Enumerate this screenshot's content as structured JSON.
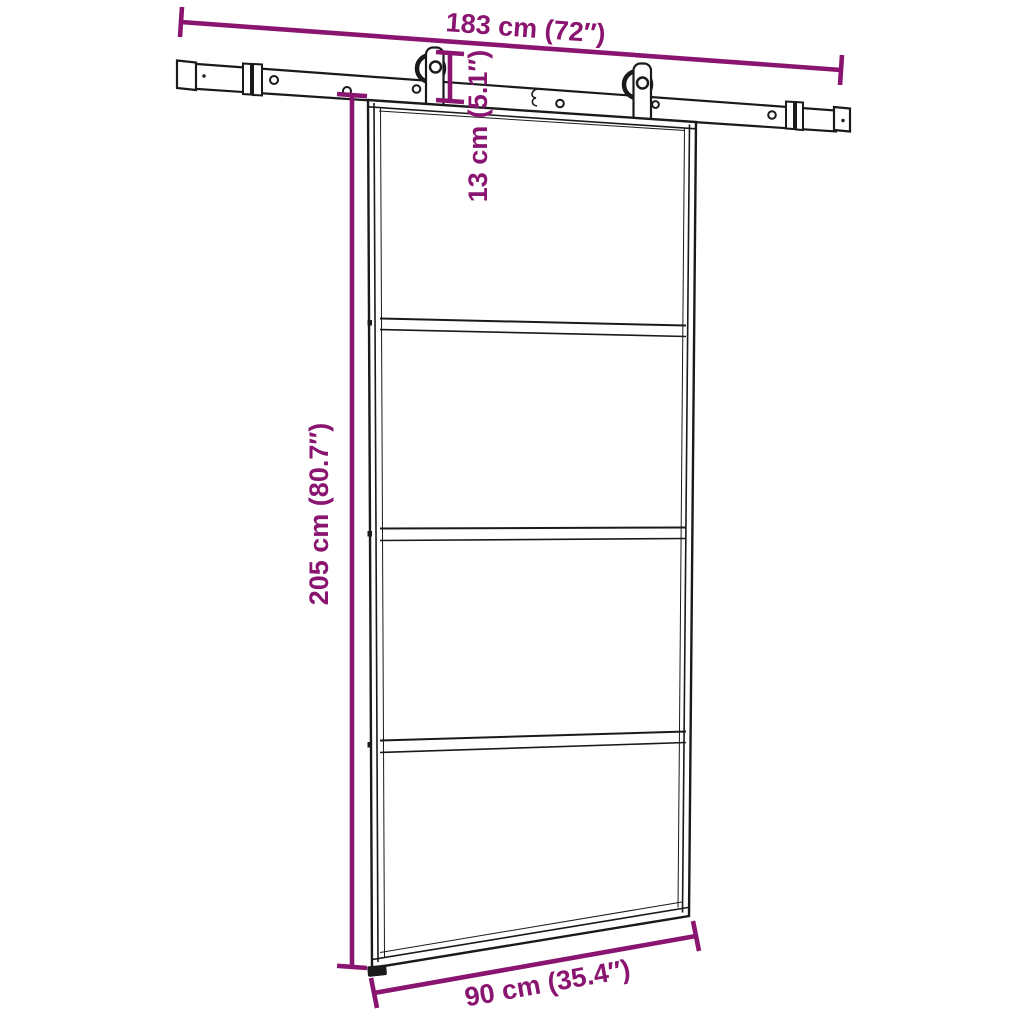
{
  "diagram": {
    "kind": "product-dimension-diagram",
    "subject": "sliding barn door with top rail hardware kit, 4-panel glass door",
    "background_color": "#ffffff",
    "outline_color": "#1a1a1a",
    "dimension_color": "#8A1570",
    "dimensions": {
      "rail_width": {
        "text": "183 cm (72″)",
        "cm": 183,
        "inch": 72
      },
      "hanger_height": {
        "text": "13 cm (5.1″)",
        "cm": 13,
        "inch": 5.1
      },
      "door_height": {
        "text": "205 cm (80.7″)",
        "cm": 205,
        "inch": 80.7
      },
      "door_width": {
        "text": "90 cm (35.4″)",
        "cm": 90,
        "inch": 35.4
      }
    },
    "door": {
      "panel_count": 4,
      "divider_count": 3,
      "roller_count": 2
    }
  }
}
